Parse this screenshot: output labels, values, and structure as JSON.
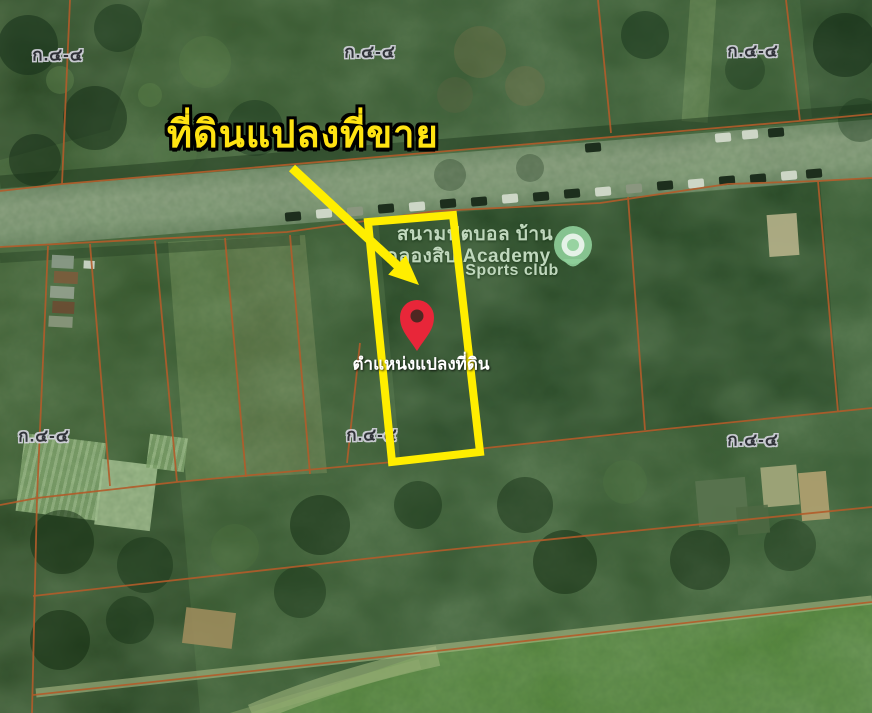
{
  "map": {
    "sheet_label": "ก.๔-๔",
    "place": {
      "name_line1": "สนามฟุตบอล บ้าน",
      "name_line2": "คลองสิบ Academy",
      "name_line3": "Sports club"
    }
  },
  "annotation": {
    "title": "ที่ดินแปลงที่ขาย",
    "pin_label": "ตำแหน่งแปลงที่ดิน"
  },
  "icons": {
    "pin": "location-pin-icon",
    "place": "sports-club-place-icon",
    "arrow": "pointer-arrow-icon"
  },
  "colors": {
    "highlight_yellow": "#ffee00",
    "title_yellow": "#ffe312",
    "parcel_line_orange": "#b35c2a",
    "pin_red": "#e82639",
    "place_label_green": "#c0d8bd",
    "sheet_label_fill": "#2e2e38"
  }
}
